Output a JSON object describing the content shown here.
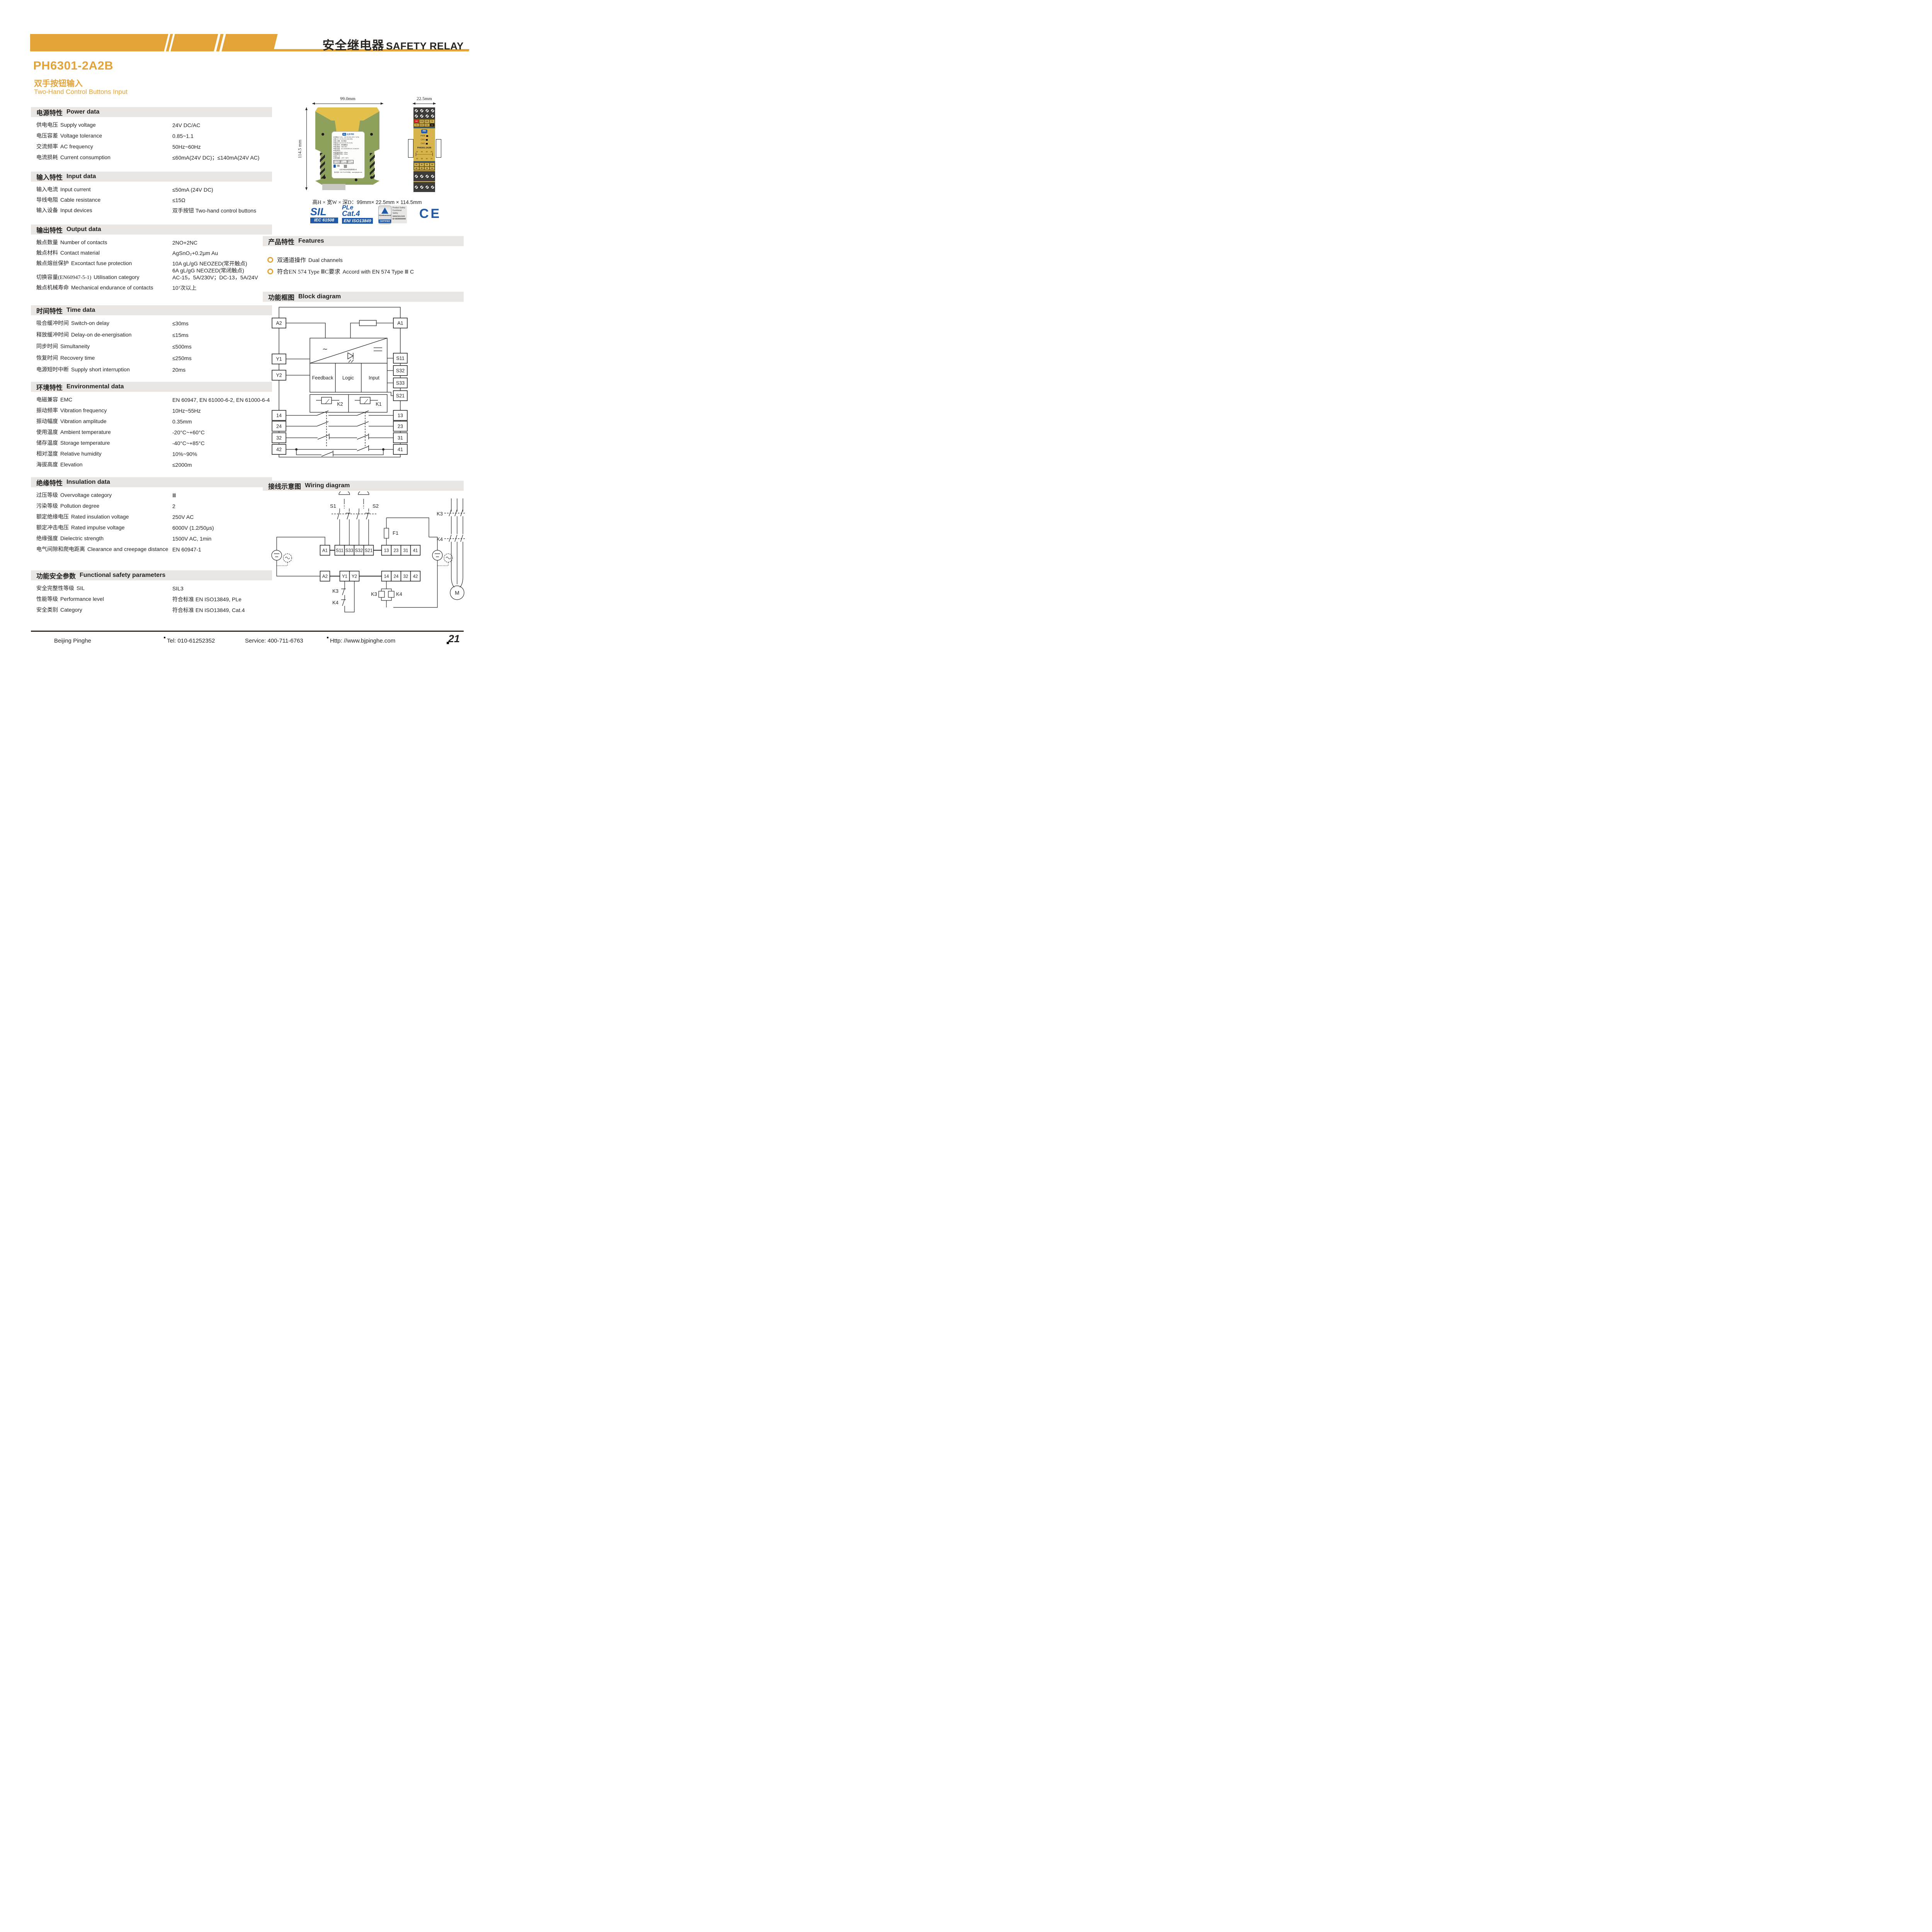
{
  "colors": {
    "gold": "#e3a338",
    "blue": "#1e5aa8",
    "red": "#dd1f26",
    "dark": "#262220",
    "bar_gray": "#e9e6e3",
    "module_yellow": "#d8b44c",
    "module_green": "#8ea15c"
  },
  "header": {
    "title_zh": "安全继电器",
    "title_en": "SAFETY RELAY"
  },
  "product": {
    "model": "PH6301-2A2B",
    "subtitle_zh": "双手按钮输入",
    "subtitle_en": "Two-Hand Control Buttons Input"
  },
  "specs": [
    {
      "id": "power",
      "title_zh": "电源特性",
      "title_en": "Power data",
      "rows": [
        {
          "zh": "供电电压",
          "en": "Supply voltage",
          "value": "24V DC/AC"
        },
        {
          "zh": "电压容差",
          "en": "Voltage tolerance",
          "value": "0.85~1.1"
        },
        {
          "zh": "交流频率",
          "en": "AC frequency",
          "value": "50Hz~60Hz"
        },
        {
          "zh": "电流损耗",
          "en": "Current consumption",
          "value": "≤60mA(24V DC)；≤140mA(24V AC)"
        }
      ]
    },
    {
      "id": "input",
      "title_zh": "输入特性",
      "title_en": "Input data",
      "rows": [
        {
          "zh": "输入电流",
          "en": "Input current",
          "value": "≤50mA (24V DC)"
        },
        {
          "zh": "导线电阻",
          "en": "Cable resistance",
          "value": "≤15Ω"
        },
        {
          "zh": "输入设备",
          "en": "Input devices",
          "value": "双手按钮 Two-hand control buttons"
        }
      ]
    },
    {
      "id": "output",
      "title_zh": "输出特性",
      "title_en": "Output data",
      "rows": [
        {
          "zh": "触点数量",
          "en": "Number of contacts",
          "value": "2NO+2NC"
        },
        {
          "zh": "触点材料",
          "en": "Contact material",
          "value": "AgSnO₂+0.2μm Au"
        },
        {
          "zh": "触点熔丝保护",
          "en": "Excontact fuse protection",
          "value": "10A gL/gG NEOZED(常开触点)\n6A gL/gG NEOZED(常闭触点)"
        },
        {
          "zh": "切换容量(EN60947-5-1)",
          "en": "Utilisation category",
          "value": "AC-15，5A/230V；DC-13，5A/24V"
        },
        {
          "zh": "触点机械寿命",
          "en": "Mechanical endurance of contacts",
          "value": "10⁷次以上"
        }
      ]
    },
    {
      "id": "time",
      "title_zh": "时间特性",
      "title_en": "Time data",
      "rows": [
        {
          "zh": "吸合缓冲时间",
          "en": "Switch-on delay",
          "value": "≤30ms"
        },
        {
          "zh": "释放缓冲时间",
          "en": "Delay-on de-energisation",
          "value": "≤15ms"
        },
        {
          "zh": "同步时间",
          "en": "Simultaneity",
          "value": "≤500ms"
        },
        {
          "zh": "恢复时间",
          "en": "Recovery time",
          "value": "≤250ms"
        },
        {
          "zh": "电源短时中断",
          "en": "Supply short interruption",
          "value": "20ms"
        }
      ]
    },
    {
      "id": "environment",
      "title_zh": "环境特性",
      "title_en": "Environmental data",
      "rows": [
        {
          "zh": "电磁兼容",
          "en": "EMC",
          "value": "EN 60947, EN 61000-6-2, EN 61000-6-4"
        },
        {
          "zh": "振动频率",
          "en": "Vibration frequency",
          "value": "10Hz~55Hz"
        },
        {
          "zh": "振动幅度",
          "en": "Vibration amplitude",
          "value": "0.35mm"
        },
        {
          "zh": "使用温度",
          "en": "Ambient temperature",
          "value": "-20°C~+60°C"
        },
        {
          "zh": "储存温度",
          "en": "Storage temperature",
          "value": "-40°C~+85°C"
        },
        {
          "zh": "相对湿度",
          "en": "Relative humidity",
          "value": "10%~90%"
        },
        {
          "zh": "海拔高度",
          "en": "Elevation",
          "value": "≤2000m"
        }
      ]
    },
    {
      "id": "insulation",
      "title_zh": "绝缘特性",
      "title_en": "Insulation data",
      "rows": [
        {
          "zh": "过压等级",
          "en": "Overvoltage category",
          "value": "Ⅲ"
        },
        {
          "zh": "污染等级",
          "en": "Pollution degree",
          "value": "2"
        },
        {
          "zh": "额定绝缘电压",
          "en": "Rated insulation voltage",
          "value": "250V AC"
        },
        {
          "zh": "额定冲击电压",
          "en": "Rated impulse voltage",
          "value": "6000V (1.2/50μs)"
        },
        {
          "zh": "绝缘强度",
          "en": "Dielectric strength",
          "value": "1500V AC, 1min"
        },
        {
          "zh": "电气间隙和爬电距离",
          "en": "Clearance and creepage distance",
          "value": "EN 60947-1"
        }
      ]
    },
    {
      "id": "safety",
      "title_zh": "功能安全参数",
      "title_en": "Functional safety parameters",
      "rows": [
        {
          "zh": "安全完整性等级",
          "en": "SIL",
          "value": "SIL3"
        },
        {
          "zh": "性能等级",
          "en": "Performance level",
          "value": "符合标准 EN ISO13849, PLe"
        },
        {
          "zh": "安全类别",
          "en": "Category",
          "value": "符合标准 EN ISO13849, Cat.4"
        }
      ]
    }
  ],
  "features": {
    "title_zh": "产品特性",
    "title_en": "Features",
    "items": [
      {
        "zh": "双通道操作",
        "en": "Dual channels"
      },
      {
        "zh": "符合EN 574 Type ⅢC要求",
        "en": "Accord with EN 574 Type Ⅲ C"
      }
    ]
  },
  "dimensions": {
    "side_top": "99.0mm",
    "side_left": "114.5 mm",
    "front_top": "22.5mm",
    "caption_zh": "高H × 宽W × 深D：",
    "caption_val": "99mm× 22.5mm × 114.5mm"
  },
  "certifications": {
    "sil": {
      "big": "SIL",
      "bar": "IEC 61508"
    },
    "ple": {
      "line1": "PLe",
      "line2": "Cat.4",
      "bar": "EN/ ISO13849"
    },
    "tuv": {
      "brand": "TÜVRheinland",
      "certified": "CERTIFIED",
      "side1": "Product Safety",
      "side2": "Functional",
      "side3": "Safety",
      "url": "www.tuv.com",
      "id": "ID 0600000000"
    },
    "ce": "CE"
  },
  "block_diagram": {
    "title_zh": "功能框图",
    "title_en": "Block diagram",
    "left_terminals": [
      "A2",
      "Y1",
      "Y2",
      "14",
      "24",
      "32",
      "42"
    ],
    "right_terminals": [
      "A1",
      "S11",
      "S32",
      "S33",
      "S21",
      "13",
      "23",
      "31",
      "41"
    ],
    "boxes": [
      "Feedback",
      "Logic",
      "Input"
    ],
    "relays": [
      "K2",
      "K1"
    ],
    "ac_symbol": "∼"
  },
  "wiring_diagram": {
    "title_zh": "接线示意图",
    "title_en": "Wiring diagram",
    "buttons": [
      "S1",
      "S2"
    ],
    "fuse": "F1",
    "row1": [
      "A1",
      "S11",
      "S33",
      "S32",
      "S21",
      "13",
      "23",
      "31",
      "41"
    ],
    "row2": [
      "A2",
      "Y1",
      "Y2",
      "14",
      "24",
      "32",
      "42"
    ],
    "feedback_contacts": [
      "K3",
      "K4"
    ],
    "coils": [
      "K3",
      "K4"
    ],
    "contactors": [
      "K3",
      "K4"
    ],
    "motor": "M"
  },
  "module_front": {
    "top_row1": [
      "A1",
      "S33",
      "S32",
      "Y2"
    ],
    "top_row2": [
      "Y1",
      "S21",
      "S11",
      "A2"
    ],
    "leds": [
      "PWR",
      "CH1",
      "CH2"
    ],
    "model": "PH6301-2A2B",
    "mini_top": [
      "41",
      "31",
      "13",
      "23"
    ],
    "mini_bottom": [
      "42",
      "32",
      "14",
      "24"
    ],
    "bottom_row1": [
      "41",
      "31",
      "13",
      "14"
    ],
    "bottom_row2": [
      "42",
      "32",
      "23",
      "24"
    ]
  },
  "module_label": {
    "brand": "北京平和",
    "lines": [
      "电源(A1+,A2-)：24V DC/AC(-15%~+10%)",
      "输入(Y1,Y2,S11,S21,S32,S33)：",
      "输入设备：双手按钮",
      "输出(13,14,23,24,31,32,41,42)：",
      "输出信号：继电器输出",
      "触点数量：2NO+2NC",
      "触点容量：AC-15,5A/250V;DC-13,5A/24V",
      "响应时间：",
      "吸合缓冲时间：≤30ms",
      "释放缓冲时间：≤15ms",
      "复位：无",
      "使用温度：-20℃~+60℃"
    ],
    "certs": [
      "SIL3 SC3\nIEC 61508",
      "PL e\nISO 13849",
      "Cat. 4\nISO 13849"
    ],
    "company": "北京平和创业科技发展有限公司",
    "support": "技术支持：400-711-6763  网址：www.bjpinghe.com"
  },
  "footer": {
    "company": "Beijing Pinghe",
    "tel": "Tel: 010-61252352",
    "service": "Service: 400-711-6763",
    "web": "Http: //www.bjpinghe.com",
    "page": "21"
  }
}
